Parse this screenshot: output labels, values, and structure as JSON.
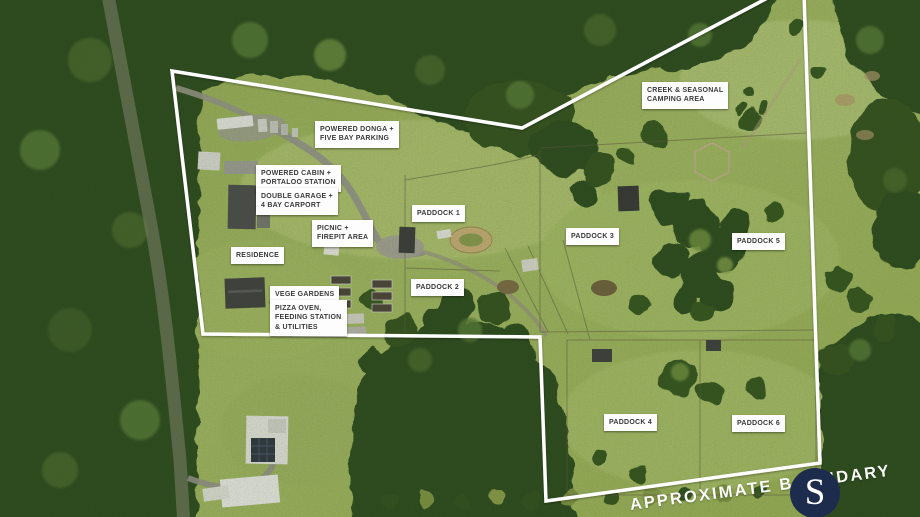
{
  "annotations": {
    "powered_donga": "POWERED DONGA +\nFIVE BAY PARKING",
    "powered_cabin": "POWERED CABIN +\nPORTALOO STATION",
    "double_garage": "DOUBLE GARAGE +\n4 BAY CARPORT",
    "picnic": "PICNIC +\nFIREPIT AREA",
    "residence": "RESIDENCE",
    "vege_gardens": "VEGE GARDENS",
    "pizza_oven": "PIZZA OVEN,\nFEEDING STATION\n& UTILITIES",
    "paddock_1": "PADDOCK 1",
    "paddock_2": "PADDOCK 2",
    "paddock_3": "PADDOCK 3",
    "paddock_4": "PADDOCK 4",
    "paddock_5": "PADDOCK 5",
    "paddock_6": "PADDOCK 6",
    "creek_camping": "CREEK & SEASONAL\nCAMPING AREA"
  },
  "watermark": {
    "text": "APPROXIMATE BOUNDARY"
  },
  "logo": {
    "letter": "S",
    "background_color": "#1d2b4d",
    "letter_color": "#ffffff"
  },
  "colors": {
    "boundary_line": "#ffffff",
    "label_background": "#fdfdfd",
    "label_text": "#3a3a3a",
    "grass": "#9db25a",
    "forest": "#2c4a1d"
  }
}
